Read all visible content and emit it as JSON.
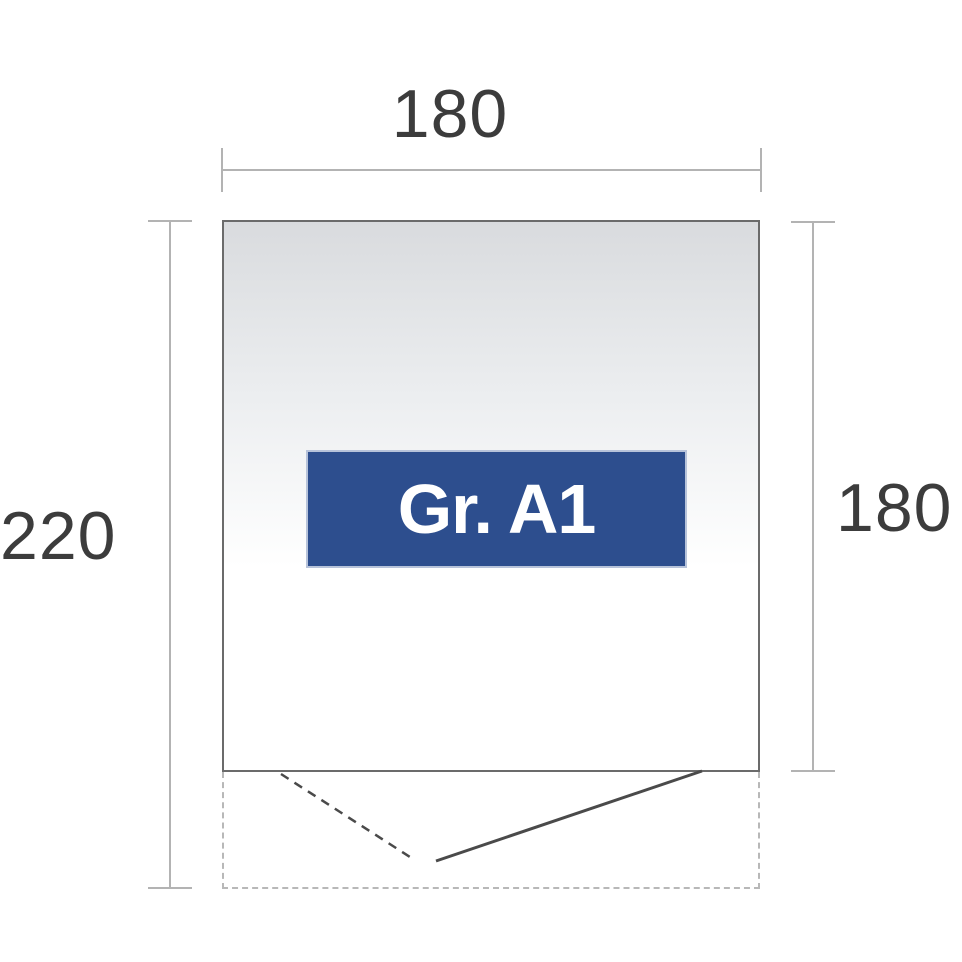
{
  "diagram": {
    "size_label": "Gr. A1",
    "dimensions": {
      "width_top": "180",
      "height_left": "220",
      "height_right": "180"
    },
    "colors": {
      "label_bg": "#2d4e8e",
      "label_border": "#b7c3da",
      "label_text": "#ffffff",
      "dim_line": "#b3b3b3",
      "dim_text": "#3c3c3c",
      "outline": "#6b6b6b",
      "dashed": "#b8b8b8",
      "door_line": "#4a4a4a",
      "fill_top": "#d9dbde",
      "fill_bottom": "#ffffff"
    }
  }
}
